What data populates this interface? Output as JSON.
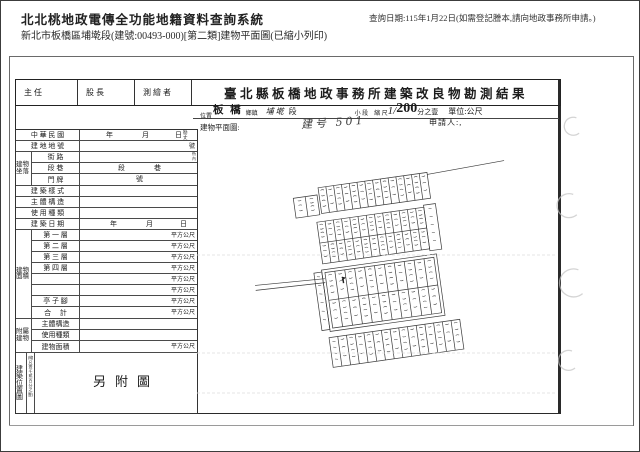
{
  "header": {
    "app_title": "北北桃地政電傳全功能地籍資料查詢系統",
    "query_date_note": "查詢日期:115年1月22日(如需登記謄本,請向地政事務所申請。)",
    "subtitle": "新北市板橋區埔墘段(建號:00493-000)[第二類]建物平面圖(已縮小列印)"
  },
  "form": {
    "approval_cells": [
      "主 任",
      "股 長",
      "測 繪 者"
    ],
    "title": "臺北縣板橋地政事務所建築改良物勘測結果",
    "location": {
      "district": "板 橋",
      "district_unit": "鄉鎮",
      "section": "埔 墘",
      "section_unit": "段",
      "subsection_label": "小 段",
      "scale_label": "縮 尺",
      "scale_prefix": "1/",
      "scale_value": "200",
      "scale_suffix": "分之壹",
      "unit_label": "單位:公尺"
    },
    "plan_label_top": "位置",
    "plan_label": "建物平面圖:",
    "handwritten_note": "建号 501",
    "applicant_label": "申請人:,",
    "rows": {
      "roc_label": "中 華 民 國",
      "year": "年",
      "month": "月",
      "day": "日",
      "survey_micro": "勘丈",
      "lot_label": "建 地 地 號",
      "lot_unit": "號",
      "address_group": "建物坐落",
      "street_label": "街 路",
      "lane_label": "段 巷",
      "lane_seg": "段",
      "lane_alley": "巷",
      "micro_side": "衖內",
      "door_label": "門 牌",
      "door_unit": "號",
      "style_label": "建 築 樣 式",
      "structure_label": "主 體 構 造",
      "usage_label": "使 用 種 類",
      "builddate_label": "建 築 日 期",
      "area_group": "建物面積",
      "floors": [
        "第 一 層",
        "第 二 層",
        "第 三 層",
        "第 四 層",
        "",
        "",
        "亭 子 腳",
        "合　 計"
      ],
      "sqm_unit": "平方公尺",
      "annex_group": "附屬建物",
      "annex_structure": "主體構造",
      "annex_usage": "使用種類",
      "annex_area": "建物面積",
      "position_group": "建築位置圖",
      "position_note": "(縮尺壹千貳百分之壹)",
      "attached_figure": "另附圖"
    }
  },
  "map_sketch": {
    "description": "hand-drawn cadastral parcel sketch, handwritten parcel numbers illegible",
    "rotation": -8,
    "pivot": [
      190,
      175
    ],
    "bands": [
      {
        "kind": "row",
        "x": 108,
        "y": 85,
        "w": 24,
        "h": 20,
        "cells": 2
      },
      {
        "kind": "row",
        "x": 134,
        "y": 78,
        "w": 110,
        "h": 26,
        "cells": 14
      },
      {
        "kind": "line",
        "x1": 244,
        "y1": 80,
        "x2": 322,
        "y2": 77
      },
      {
        "kind": "grid",
        "x": 128,
        "y": 112,
        "w": 108,
        "h": 42,
        "cols": 13,
        "rows": 2
      },
      {
        "kind": "row",
        "x": 236,
        "y": 110,
        "w": 12,
        "h": 46,
        "cells": 1,
        "vlabel": true
      },
      {
        "kind": "line",
        "x1": 58,
        "y1": 166,
        "x2": 128,
        "y2": 169
      },
      {
        "kind": "line",
        "x1": 58,
        "y1": 171,
        "x2": 128,
        "y2": 173
      },
      {
        "kind": "frame",
        "x": 126,
        "y": 160,
        "w": 116,
        "h": 62,
        "cols": 11,
        "rows": 2,
        "inset": 3
      },
      {
        "kind": "row",
        "x": 118,
        "y": 162,
        "w": 8,
        "h": 58,
        "cells": 1,
        "vlabel": true
      },
      {
        "kind": "row",
        "x": 124,
        "y": 228,
        "w": 132,
        "h": 30,
        "cells": 15,
        "firstLabel": true
      },
      {
        "kind": "blob",
        "x": 146,
        "y": 170
      }
    ],
    "scanlines": [
      154,
      252,
      292
    ],
    "pen_marks": [
      {
        "cx": 374,
        "cy": 24,
        "r": 9
      },
      {
        "cx": 369,
        "cy": 103,
        "r": 12
      },
      {
        "cx": 373,
        "cy": 180,
        "r": 14
      },
      {
        "cx": 369,
        "cy": 258,
        "r": 10
      }
    ],
    "ink": "#3a3a3a",
    "pen_color": "#c2c2c2"
  }
}
